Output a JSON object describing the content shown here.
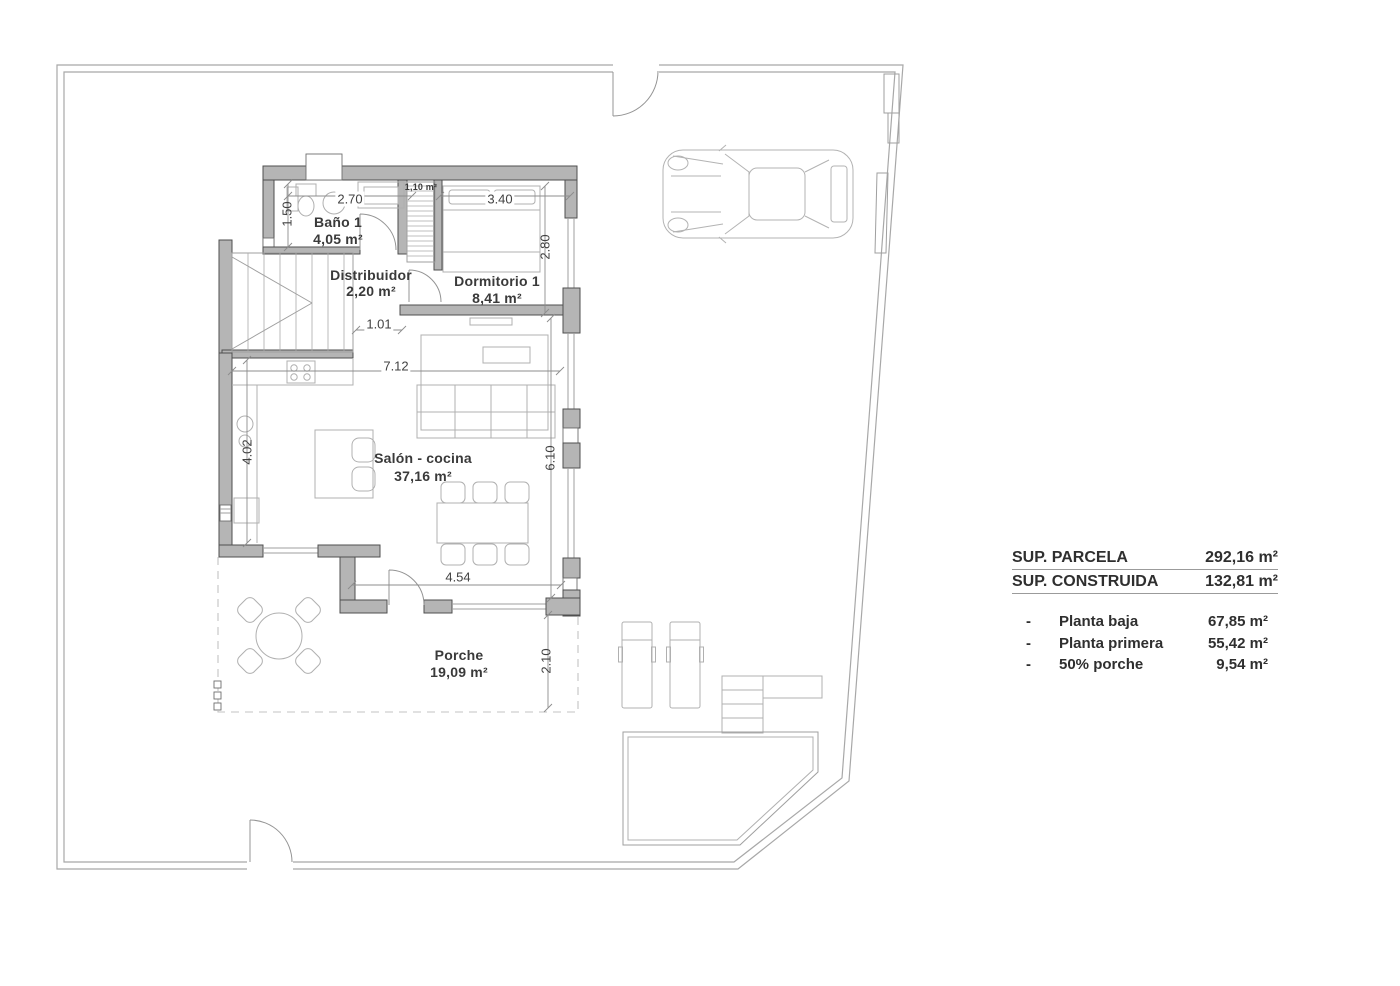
{
  "plan": {
    "rooms": [
      {
        "name": "Baño 1",
        "area": "4,05 m²"
      },
      {
        "name": "Distribuidor",
        "area": "2,20 m²"
      },
      {
        "name": "Dormitorio 1",
        "area": "8,41 m²"
      },
      {
        "name": "Salón - cocina",
        "area": "37,16 m²"
      },
      {
        "name": "Porche",
        "area": "19,09 m²"
      }
    ],
    "closet_area": "1,10 m²",
    "dims": {
      "w_bano": "2.70",
      "w_dorm": "3.40",
      "h_bano": "1.50",
      "h_dorm": "2.80",
      "w_pass": "1.01",
      "w_salon": "7.12",
      "h_salon_left": "4.02",
      "h_salon_right": "6.10",
      "w_porche": "4.54",
      "d_porche": "2.10"
    }
  },
  "summary": {
    "header_rows": [
      {
        "label": "SUP. PARCELA",
        "value": "292,16 m²"
      },
      {
        "label": "SUP. CONSTRUIDA",
        "value": "132,81 m²"
      }
    ],
    "items": [
      {
        "bullet": "-",
        "label": "Planta baja",
        "value": "67,85 m²"
      },
      {
        "bullet": "-",
        "label": "Planta primera",
        "value": "55,42 m²"
      },
      {
        "bullet": "-",
        "label": "50% porche",
        "value": "9,54 m²"
      }
    ]
  },
  "colors": {
    "wall_fill": "#b5b5b5",
    "line_gray": "#a8a8a8",
    "text_gray": "#3a3a3a"
  }
}
